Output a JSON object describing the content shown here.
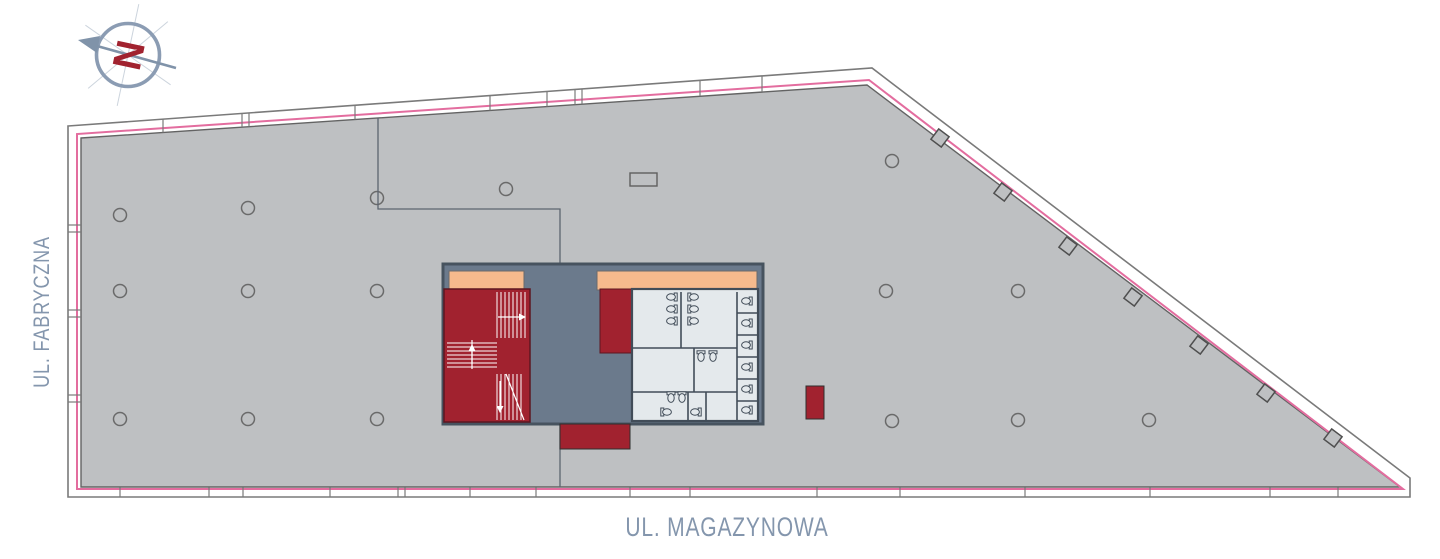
{
  "canvas": {
    "width": 1440,
    "height": 559,
    "background": "#ffffff"
  },
  "streets": {
    "left": "UL. FABRYCZNA",
    "bottom": "UL. MAGAZYNOWA",
    "color": "#8496ad"
  },
  "compass": {
    "letter": "N",
    "ring_color": "#8b9cb3",
    "needle_color": "#8093a9",
    "letter_color": "#a1222f",
    "cx": 128,
    "cy": 55,
    "r": 31.5
  },
  "plan": {
    "floor_fill": "#bec0c2",
    "outline_stroke": "#7a7a7a",
    "inner_stroke": "#636363",
    "accent_pink": "#e36d9f",
    "outer_polygon": [
      [
        68,
        126
      ],
      [
        872,
        68
      ],
      [
        1410,
        478
      ],
      [
        1410,
        497
      ],
      [
        68,
        497
      ]
    ],
    "inner_polygon": [
      [
        81,
        138
      ],
      [
        867,
        85
      ],
      [
        1400,
        487
      ],
      [
        81,
        487
      ]
    ],
    "pink_polygon": [
      [
        77,
        489
      ],
      [
        77,
        134
      ],
      [
        869,
        80
      ],
      [
        1403,
        489
      ]
    ],
    "top_ticks_x": [
      163,
      242,
      249,
      355,
      490,
      547,
      575,
      582,
      700,
      762
    ],
    "bottom_ticks_x": [
      120,
      209,
      243,
      330,
      398,
      405,
      470,
      536,
      630,
      690,
      817,
      900,
      1025,
      1150,
      1270,
      1338
    ],
    "left_ticks_y": [
      225,
      232,
      310,
      317,
      395,
      402
    ],
    "diag_squares": [
      [
        940,
        138
      ],
      [
        1003,
        192
      ],
      [
        1068,
        246
      ],
      [
        1133,
        297
      ],
      [
        1199,
        345
      ],
      [
        1266,
        393
      ],
      [
        1333,
        438
      ]
    ],
    "columns": [
      [
        120,
        215
      ],
      [
        248,
        208
      ],
      [
        377,
        198
      ],
      [
        506,
        189
      ],
      [
        892,
        161
      ],
      [
        120,
        291
      ],
      [
        248,
        291
      ],
      [
        377,
        291
      ],
      [
        886,
        291
      ],
      [
        1018,
        291
      ],
      [
        120,
        419
      ],
      [
        248,
        419
      ],
      [
        377,
        419
      ],
      [
        892,
        421
      ],
      [
        1018,
        420
      ],
      [
        1149,
        420
      ]
    ],
    "rect_marker": [
      630,
      173,
      27,
      13
    ],
    "demising": [
      [
        [
          378,
          118
        ],
        [
          378,
          209
        ],
        [
          560,
          209
        ],
        [
          560,
          270
        ]
      ],
      [
        [
          560,
          424
        ],
        [
          560,
          487
        ]
      ]
    ],
    "core": {
      "base": [
        443,
        264,
        320,
        160
      ],
      "slate": "#6b7a8c",
      "stroke": "#47535f",
      "peach": "#f6ba8d",
      "peach1": [
        449,
        271,
        75,
        19
      ],
      "peach2": [
        597,
        271,
        160,
        19
      ],
      "red": "#a1222f",
      "stair_rect": [
        444,
        289,
        86,
        133
      ],
      "red_mid": [
        600,
        289,
        32,
        64
      ],
      "red_below": [
        560,
        424,
        70,
        25
      ],
      "red_free": [
        806,
        386,
        18,
        33
      ],
      "wc": [
        632,
        289,
        126,
        132
      ],
      "wc_fill": "#e4e9ec",
      "wc_stroke": "#414c58",
      "wc_walls": [
        [
          681,
          292,
          681,
          348
        ],
        [
          737,
          292,
          737,
          421
        ],
        [
          632,
          348,
          737,
          348
        ],
        [
          632,
          392,
          737,
          392
        ],
        [
          694,
          348,
          694,
          392
        ],
        [
          688,
          392,
          688,
          421
        ],
        [
          706,
          392,
          706,
          421
        ],
        [
          737,
          313,
          758,
          313
        ],
        [
          737,
          335,
          758,
          335
        ],
        [
          737,
          357,
          758,
          357
        ],
        [
          737,
          379,
          758,
          379
        ],
        [
          737,
          401,
          758,
          401
        ]
      ],
      "fixtures": [
        [
          671,
          297,
          "L"
        ],
        [
          671,
          309,
          "L"
        ],
        [
          671,
          321,
          "L"
        ],
        [
          694,
          297,
          "R"
        ],
        [
          694,
          309,
          "R"
        ],
        [
          694,
          321,
          "R"
        ],
        [
          746,
          301,
          "L"
        ],
        [
          746,
          323,
          "L"
        ],
        [
          746,
          345,
          "L"
        ],
        [
          746,
          367,
          "L"
        ],
        [
          746,
          389,
          "L"
        ],
        [
          746,
          410,
          "L"
        ],
        [
          701,
          357,
          "D"
        ],
        [
          713,
          357,
          "D"
        ],
        [
          671,
          398,
          "D"
        ],
        [
          682,
          398,
          "D"
        ],
        [
          667,
          412,
          "R"
        ],
        [
          695,
          412,
          "L"
        ]
      ],
      "stairs": {
        "v_top": [
          497,
          527,
          4,
          292,
          338
        ],
        "h_mid": [
          343,
          367,
          4,
          447,
          497
        ],
        "v_bot": [
          497,
          521,
          4,
          374,
          420
        ],
        "divider": [
          472,
          340,
          472,
          369
        ],
        "diag": [
          506,
          374,
          524,
          420
        ],
        "arrow_lines": [
          [
            498,
            317,
            522,
            317
          ],
          [
            472,
            364,
            472,
            348
          ],
          [
            500,
            381,
            500,
            409
          ]
        ],
        "arrow_heads": [
          [
            [
              526,
              317
            ],
            [
              519,
              313.5
            ],
            [
              519,
              320.5
            ]
          ],
          [
            [
              472,
              344
            ],
            [
              468.5,
              351
            ],
            [
              475.5,
              351
            ]
          ],
          [
            [
              500,
              413
            ],
            [
              496.5,
              406
            ],
            [
              503.5,
              406
            ]
          ]
        ]
      }
    }
  }
}
